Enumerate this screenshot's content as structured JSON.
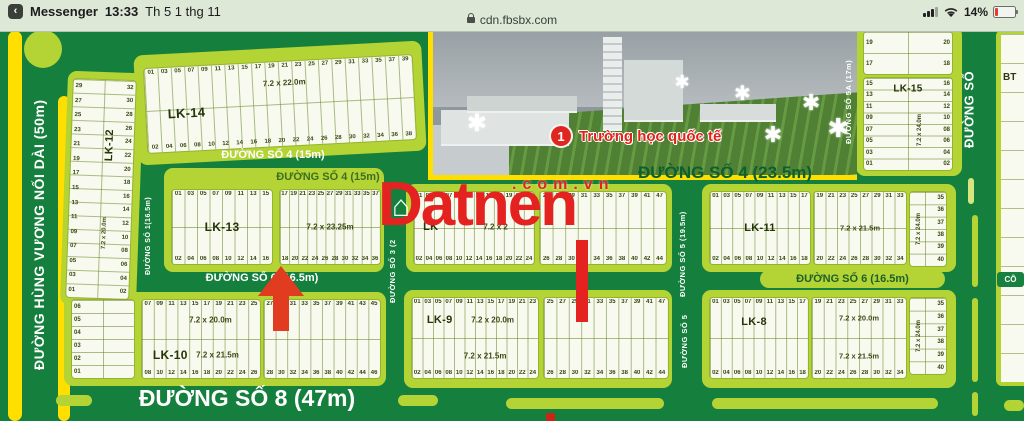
{
  "status_bar": {
    "back_icon": "‹",
    "app_name": "Messenger",
    "time": "13:33",
    "date": "Th 5 1 thg 11",
    "url": "cdn.fbsbx.com",
    "battery": "14%"
  },
  "map": {
    "watermark": {
      "brand": "Datnen",
      "suffix": ".com.vn"
    },
    "school": {
      "badge": "1",
      "label": "Trường học quốc tế"
    },
    "bt_label": "BT",
    "co_label": "CÔ",
    "streets": [
      {
        "id": "hung-vuong",
        "label": "ĐƯỜNG HÙNG VƯƠNG NỐI DÀI (50m)"
      },
      {
        "id": "so1",
        "label": "ĐƯỜNG SỐ 1(16.5m)"
      },
      {
        "id": "so3",
        "label": "ĐƯỜNG SỐ 3 (2"
      },
      {
        "id": "so5",
        "label": "ĐƯỜNG SỐ 5 (19.5m)"
      },
      {
        "id": "so5b",
        "label": "ĐƯỜNG SỐ 5"
      },
      {
        "id": "so5a",
        "label": "ĐƯỜNG SỐ 5A (17m)"
      },
      {
        "id": "so-right",
        "label": "ĐƯỜNG SỐ"
      },
      {
        "id": "so4-15-road",
        "label": "ĐƯỜNG SỐ 4 (15m)"
      },
      {
        "id": "so4-15-block",
        "label": "ĐƯỜNG SỐ 4 (15m)"
      },
      {
        "id": "so4-235",
        "label": "ĐƯỜNG SỐ 4 (23.5m)"
      },
      {
        "id": "so6-left",
        "label": "ĐƯỜNG SỐ 6 (16.5m)"
      },
      {
        "id": "so6-right",
        "label": "ĐƯỜNG SỐ 6 (16.5m)"
      },
      {
        "id": "so8",
        "label": "ĐƯỜNG SỐ 8 (47m)"
      }
    ],
    "blocks": [
      {
        "id": "lk14",
        "label": "LK-14",
        "dim": "7.2 x 22.0m",
        "top": [
          "01",
          "03",
          "05",
          "07",
          "09",
          "11",
          "13",
          "15",
          "17",
          "19",
          "21",
          "23",
          "25",
          "27",
          "29",
          "31",
          "33",
          "35",
          "37",
          "39"
        ],
        "bottom": [
          "02",
          "04",
          "06",
          "08",
          "10",
          "12",
          "14",
          "16",
          "18",
          "20",
          "22",
          "24",
          "26",
          "28",
          "30",
          "32",
          "34",
          "36",
          "38"
        ]
      },
      {
        "id": "lk12",
        "label": "LK-12",
        "dim": "7.2 x 20.0m",
        "left": [
          "29",
          "27",
          "25",
          "23",
          "21",
          "19",
          "17",
          "15",
          "13",
          "11",
          "09",
          "07",
          "05",
          "03",
          "01"
        ],
        "right": [
          "32",
          "30",
          "28",
          "26",
          "24",
          "22",
          "20",
          "18",
          "16",
          "14",
          "12",
          "10",
          "08",
          "06",
          "04",
          "02"
        ]
      },
      {
        "id": "lk15top",
        "left": [
          "19",
          "17"
        ],
        "right": [
          "20",
          "18"
        ]
      },
      {
        "id": "lk15",
        "label": "LK-15",
        "dim": "7.2 x 24.0m",
        "left": [
          "15",
          "13",
          "11",
          "09",
          "07",
          "05",
          "03",
          "01"
        ],
        "right": [
          "16",
          "14",
          "12",
          "10",
          "08",
          "06",
          "04",
          "02"
        ]
      },
      {
        "id": "lk13a",
        "label": "LK-13",
        "top": [
          "01",
          "03",
          "05",
          "07",
          "09",
          "11",
          "13",
          "15"
        ],
        "bottom": [
          "02",
          "04",
          "06",
          "08",
          "10",
          "12",
          "14",
          "16"
        ]
      },
      {
        "id": "lk13b",
        "dim": "7.2 x 23.25m",
        "top": [
          "17",
          "19",
          "21",
          "23",
          "25",
          "27",
          "29",
          "31",
          "33",
          "35",
          "37"
        ],
        "bottom": [
          "18",
          "20",
          "22",
          "24",
          "26",
          "28",
          "30",
          "32",
          "34",
          "36"
        ]
      },
      {
        "id": "lkxa",
        "label": "LK",
        "dim": "7.2 x 2",
        "top": [
          "01",
          "03",
          "05",
          "07",
          "09",
          "11",
          "13",
          "15",
          "17",
          "19",
          "21",
          "23"
        ],
        "bottom": [
          "02",
          "04",
          "06",
          "08",
          "10",
          "12",
          "14",
          "16",
          "18",
          "20",
          "22",
          "24"
        ]
      },
      {
        "id": "lkxb",
        "top": [
          "25",
          "27",
          "29",
          "31",
          "33",
          "35",
          "37",
          "39",
          "41",
          "47"
        ],
        "bottom": [
          "26",
          "28",
          "30",
          "32",
          "34",
          "36",
          "38",
          "40",
          "42",
          "44"
        ]
      },
      {
        "id": "lk11a",
        "label": "LK-11",
        "top": [
          "01",
          "03",
          "05",
          "07",
          "09",
          "11",
          "13",
          "15",
          "17"
        ],
        "bottom": [
          "02",
          "04",
          "06",
          "08",
          "10",
          "12",
          "14",
          "16",
          "18"
        ]
      },
      {
        "id": "lk11b",
        "dim": "7.2 x 21.5m",
        "top": [
          "19",
          "21",
          "23",
          "25",
          "27",
          "29",
          "31",
          "33"
        ],
        "bottom": [
          "20",
          "22",
          "24",
          "26",
          "28",
          "30",
          "32",
          "34"
        ]
      },
      {
        "id": "strip2",
        "dim": "7.2 x 24.0m",
        "right": [
          "35",
          "36",
          "37",
          "38",
          "39",
          "40"
        ]
      },
      {
        "id": "small10",
        "left": [
          "06",
          "05",
          "04",
          "03",
          "02",
          "01"
        ]
      },
      {
        "id": "lk10a",
        "label": "LK-10",
        "dim_top": "7.2 x 20.0m",
        "dim_bottom": "7.2 x 21.5m",
        "top": [
          "07",
          "09",
          "11",
          "13",
          "15",
          "17",
          "19",
          "21",
          "23",
          "25"
        ],
        "bottom": [
          "08",
          "10",
          "12",
          "14",
          "16",
          "18",
          "20",
          "22",
          "24",
          "26"
        ]
      },
      {
        "id": "lk10b",
        "top": [
          "27",
          "29",
          "31",
          "33",
          "35",
          "37",
          "39",
          "41",
          "43",
          "45"
        ],
        "bottom": [
          "28",
          "30",
          "32",
          "34",
          "36",
          "38",
          "40",
          "42",
          "44",
          "46"
        ]
      },
      {
        "id": "lk9a",
        "label": "LK-9",
        "dim_top": "7.2 x 20.0m",
        "dim_bottom": "7.2 x 21.5m",
        "top": [
          "01",
          "03",
          "05",
          "07",
          "09",
          "11",
          "13",
          "15",
          "17",
          "19",
          "21",
          "23"
        ],
        "bottom": [
          "02",
          "04",
          "06",
          "08",
          "10",
          "12",
          "14",
          "16",
          "18",
          "20",
          "22",
          "24"
        ]
      },
      {
        "id": "lk9b",
        "top": [
          "25",
          "27",
          "29",
          "31",
          "33",
          "35",
          "37",
          "39",
          "41",
          "47"
        ],
        "bottom": [
          "26",
          "28",
          "30",
          "32",
          "34",
          "36",
          "38",
          "40",
          "42",
          "44"
        ]
      },
      {
        "id": "lk8a",
        "label": "LK-8",
        "top": [
          "01",
          "03",
          "05",
          "07",
          "09",
          "11",
          "13",
          "15",
          "17"
        ],
        "bottom": [
          "02",
          "04",
          "06",
          "08",
          "10",
          "12",
          "14",
          "16",
          "18"
        ]
      },
      {
        "id": "lk8b",
        "dim_top": "7.2 x 20.0m",
        "dim_bottom": "7.2 x 21.5m",
        "top": [
          "19",
          "21",
          "23",
          "25",
          "27",
          "29",
          "31",
          "33"
        ],
        "bottom": [
          "20",
          "22",
          "24",
          "26",
          "28",
          "30",
          "32",
          "34"
        ]
      },
      {
        "id": "strip3",
        "dim": "7.2 x 24.0m",
        "right": [
          "35",
          "36",
          "37",
          "38",
          "39",
          "40"
        ]
      }
    ]
  }
}
